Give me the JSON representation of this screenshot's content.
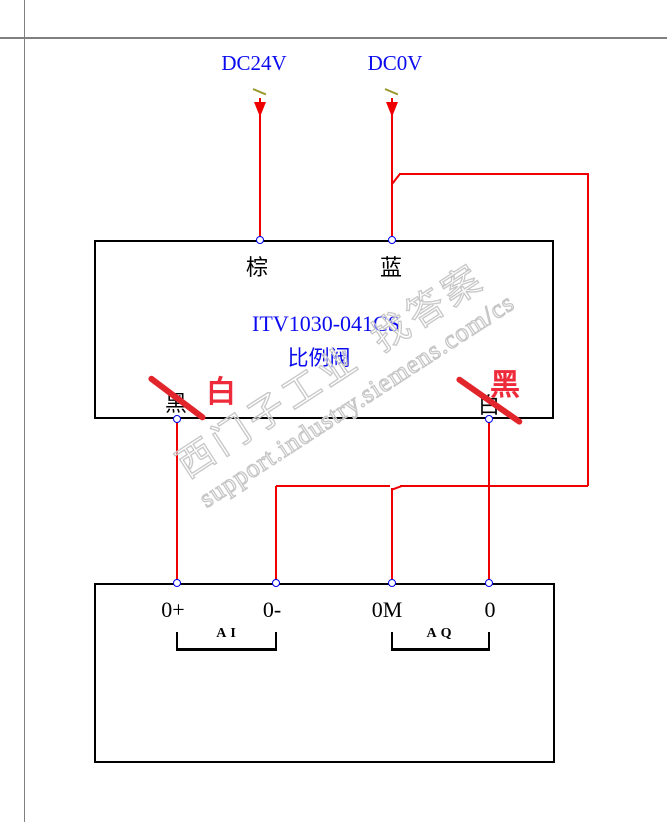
{
  "power": {
    "positive_label": "DC24V",
    "zero_label": "DC0V"
  },
  "valve": {
    "model": "ITV1030-041CS",
    "name": "比例阀",
    "terminal_top_left": "棕",
    "terminal_top_right": "蓝",
    "bottom_left_original": "黑",
    "bottom_left_correction": "白",
    "bottom_right_original": "白",
    "bottom_right_correction": "黑"
  },
  "plc": {
    "terminals": [
      {
        "label": "0+"
      },
      {
        "label": "0-"
      },
      {
        "label": "0M"
      },
      {
        "label": "0"
      }
    ],
    "groups": [
      {
        "label": "AI"
      },
      {
        "label": "AQ"
      }
    ]
  },
  "watermark": {
    "part1": "西门子工业",
    "part2": "找答案",
    "line2": "support.industry.siemens.com/cs"
  },
  "colors": {
    "wire_red": "#ef0000",
    "mark_red": "#e2242b",
    "text_blue": "#0b0bf0",
    "terminal_blue": "#0000ee",
    "frame_gray": "#808080",
    "watermark_gray": "#c7c7c7",
    "tick_olive": "#99992e"
  }
}
